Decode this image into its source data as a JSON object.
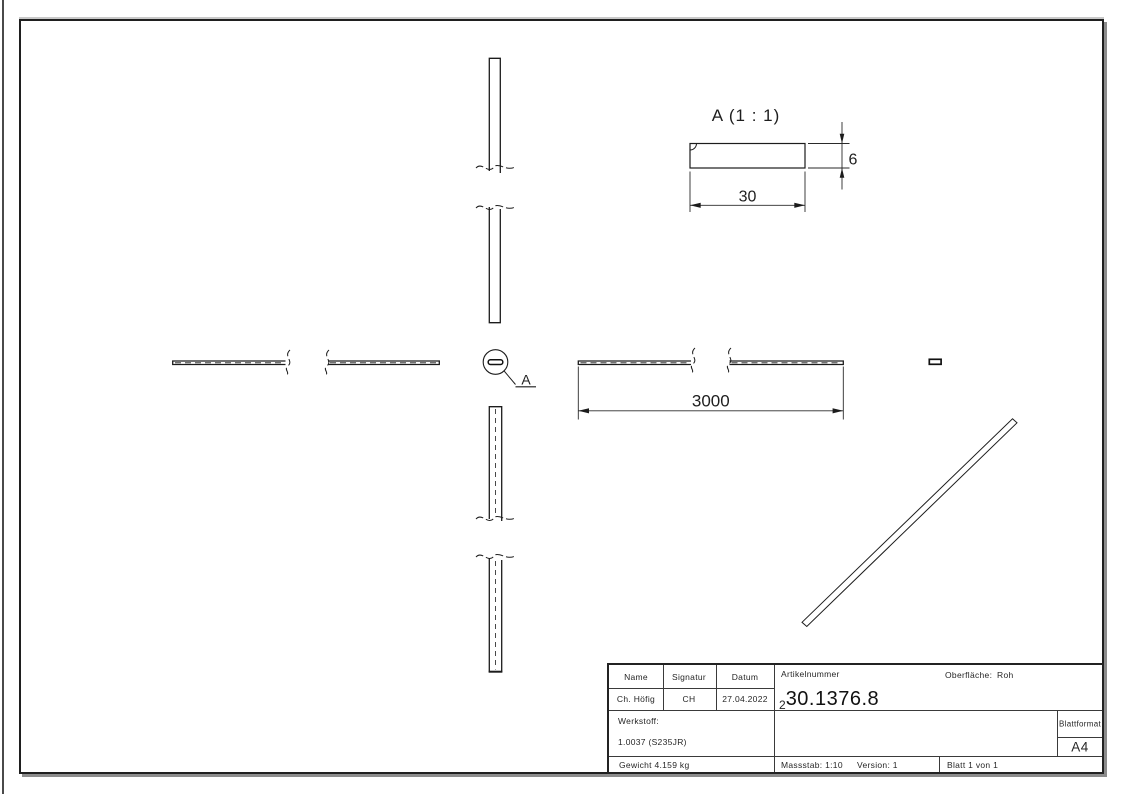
{
  "drawing": {
    "detail_view": {
      "title": "A (1 : 1)",
      "width_dim": "30",
      "thickness_dim": "6"
    },
    "main_view": {
      "length_dim": "3000"
    },
    "detail_callout": {
      "label": "A"
    }
  },
  "title_block": {
    "name_header": "Name",
    "signatur_header": "Signatur",
    "datum_header": "Datum",
    "name_value": "Ch. Höfig",
    "signatur_value": "CH",
    "datum_value": "27.04.2022",
    "artikelnummer_label": "Artikelnummer",
    "artikelnummer_prefix": "2",
    "artikelnummer_value": "30.1376.8",
    "oberflaeche_label": "Oberfläche:",
    "oberflaeche_value": "Roh",
    "werkstoff_label": "Werkstoff:",
    "werkstoff_value": "1.0037 (S235JR)",
    "blattformat_label": "Blattformat",
    "blattformat_value": "A4",
    "gewicht": "Gewicht 4.159 kg",
    "massstab": "Massstab: 1:10",
    "version": "Version: 1",
    "blatt": "Blatt 1 von 1"
  }
}
